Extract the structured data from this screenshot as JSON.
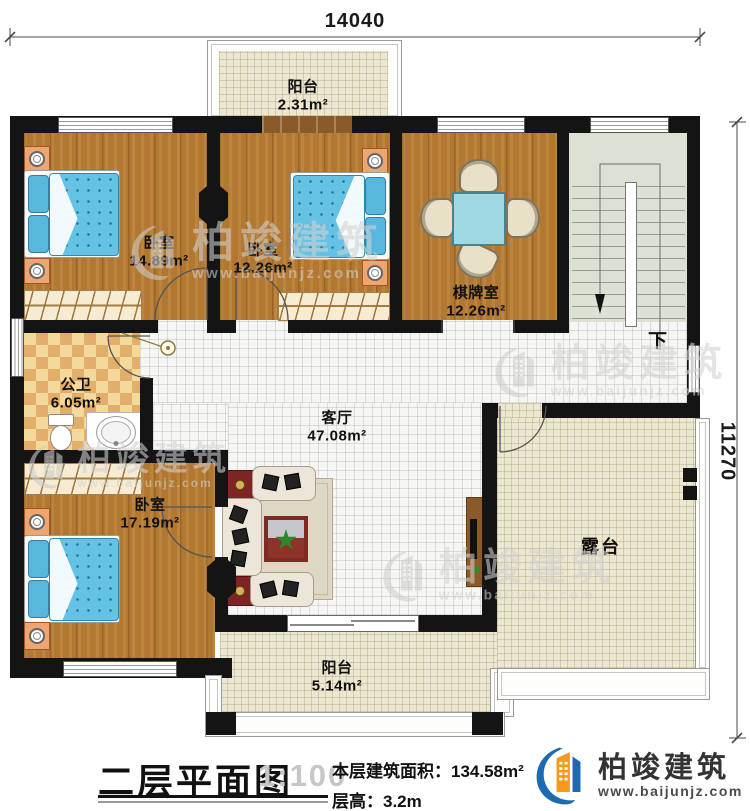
{
  "plan": {
    "dim_top": "14040",
    "dim_right": "11270",
    "stairs_down": "下",
    "rooms": {
      "balcony_top": {
        "name": "阳台",
        "area": "2.31m²"
      },
      "bedroom1": {
        "name": "卧室",
        "area": "14.89m²"
      },
      "bedroom2": {
        "name": "卧室",
        "area": "12.26m²"
      },
      "mahjong": {
        "name": "棋牌室",
        "area": "12.26m²"
      },
      "bathroom": {
        "name": "公卫",
        "area": "6.05m²"
      },
      "bedroom3": {
        "name": "卧室",
        "area": "17.19m²"
      },
      "living": {
        "name": "客厅",
        "area": "47.08m²"
      },
      "terrace": {
        "name": "露台"
      },
      "balcony_bottom": {
        "name": "阳台",
        "area": "5.14m²"
      }
    }
  },
  "title_block": {
    "title": "二层平面图",
    "scale": "1:100",
    "area": "本层建筑面积：134.58m²",
    "floor_height": "层高：3.2m"
  },
  "brand": {
    "name": "柏竣建筑",
    "site": "www.baijunjz.com"
  }
}
